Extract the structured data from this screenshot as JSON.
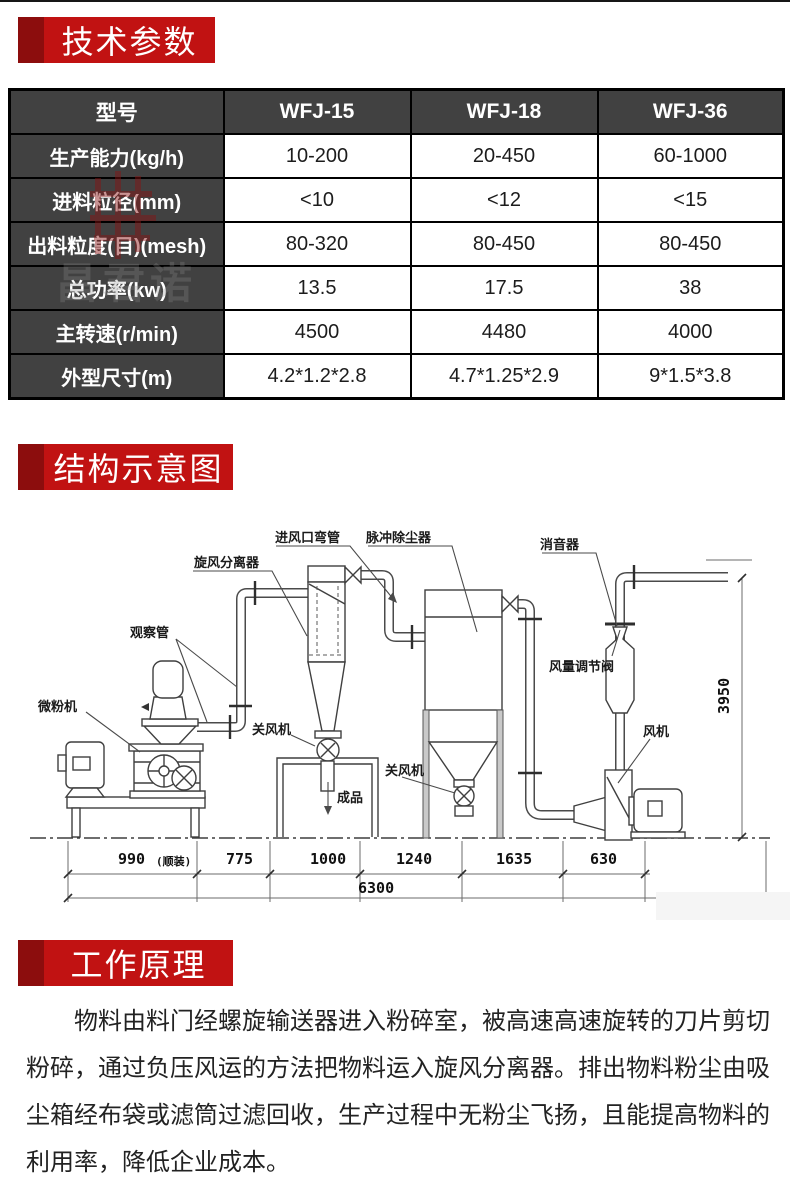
{
  "banners": {
    "tech": "技术参数",
    "structure": "结构示意图",
    "principle": "工作原理"
  },
  "table": {
    "header": [
      "型号",
      "WFJ-15",
      "WFJ-18",
      "WFJ-36"
    ],
    "rows": [
      {
        "label": "生产能力(kg/h)",
        "values": [
          "10-200",
          "20-450",
          "60-1000"
        ]
      },
      {
        "label": "进料粒径(mm)",
        "values": [
          "<10",
          "<12",
          "<15"
        ]
      },
      {
        "label": "出料粒度(目)(mesh)",
        "values": [
          "80-320",
          "80-450",
          "80-450"
        ]
      },
      {
        "label": "总功率(kw)",
        "values": [
          "13.5",
          "17.5",
          "38"
        ]
      },
      {
        "label": "主转速(r/min)",
        "values": [
          "4500",
          "4480",
          "4000"
        ]
      },
      {
        "label": "外型尺寸(m)",
        "values": [
          "4.2*1.2*2.8",
          "4.7*1.25*2.9",
          "9*1.5*3.8"
        ]
      }
    ]
  },
  "diagram": {
    "labels": {
      "mill": "微粉机",
      "observation_pipe": "观察管",
      "cyclone_separator": "旋风分离器",
      "inlet_elbow": "进风口弯管",
      "pulse_dust_collector": "脉冲除尘器",
      "muffler": "消音器",
      "air_volume_valve": "风量调节阀",
      "rotary_airlock": "关风机",
      "finished_product": "成品",
      "fan": "风机"
    },
    "dims": {
      "d990": "990",
      "d990_note": "(顺装)",
      "d775": "775",
      "d1000": "1000",
      "d1240": "1240",
      "d1635": "1635",
      "d630": "630",
      "total": "6300",
      "height": "3950"
    }
  },
  "principle": {
    "text": "物料由料门经螺旋输送器进入粉碎室，被高速高速旋转的刀片剪切粉碎，通过负压风运的方法把物料运入旋风分离器。排出物料粉尘由吸尘箱经布袋或滤筒过滤回收，生产过程中无粉尘飞扬，且能提高物料的利用率，降低企业成本。"
  },
  "watermark": {
    "text": "昌君诺"
  },
  "colors": {
    "banner_red": "#c11212",
    "banner_dark": "#8c0d0d",
    "table_header_bg": "#414141",
    "table_border": "#000000",
    "stamp_red": "#8a1111"
  }
}
